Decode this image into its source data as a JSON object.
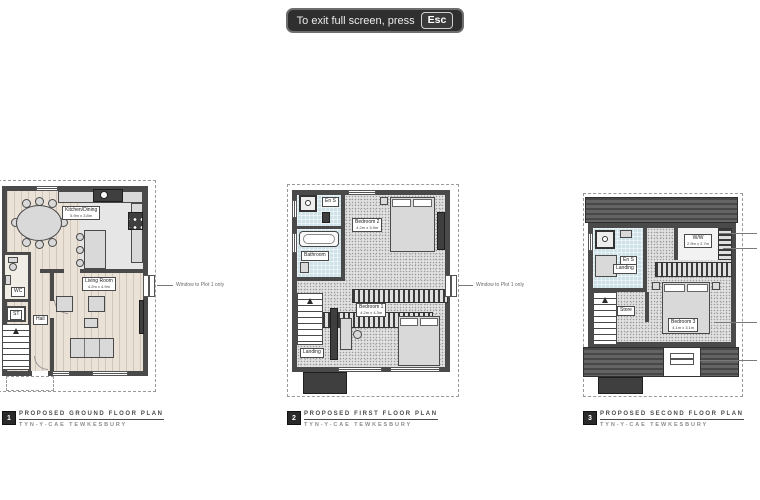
{
  "toast": {
    "message": "To exit full screen, press",
    "key": "Esc"
  },
  "plans": {
    "ground": {
      "logo": "1",
      "title": "PROPOSED GROUND FLOOR PLAN",
      "subtitle": "TYN-Y-CAE TEWKESBURY",
      "annotation": "Window to Plot 1 only",
      "rooms": {
        "kitchen": {
          "name": "Kitchen/Dining",
          "dims": "5.9m x 3.8m"
        },
        "living": {
          "name": "Living Room",
          "dims": "4.2m x 4.9m"
        },
        "wc": {
          "name": "WC"
        },
        "store": {
          "name": "ST"
        },
        "hall": {
          "name": "Hall"
        }
      }
    },
    "first": {
      "logo": "2",
      "title": "PROPOSED FIRST FLOOR PLAN",
      "subtitle": "TYN-Y-CAE TEWKESBURY",
      "annotation": "Window to Plot 1 only",
      "rooms": {
        "ensuite": {
          "name": "En S"
        },
        "bathroom": {
          "name": "Bathroom"
        },
        "bedroom2": {
          "name": "Bedroom 2",
          "dims": "4.2m x 3.9m"
        },
        "bedroom1": {
          "name": "Bedroom 1",
          "dims": "4.2m x 4.3m"
        },
        "landing": {
          "name": "Landing"
        }
      }
    },
    "second": {
      "logo": "3",
      "title": "PROPOSED SECOND FLOOR PLAN",
      "subtitle": "TYN-Y-CAE TEWKESBURY",
      "rooms": {
        "ww": {
          "name": "W/W",
          "dims": "2.9m x 2.7m"
        },
        "ensuite": {
          "name": "En S"
        },
        "landing": {
          "name": "Landing"
        },
        "store": {
          "name": "Store"
        },
        "bedroom3": {
          "name": "Bedroom 3",
          "dims": "4.1m x 3.1m"
        }
      }
    }
  }
}
